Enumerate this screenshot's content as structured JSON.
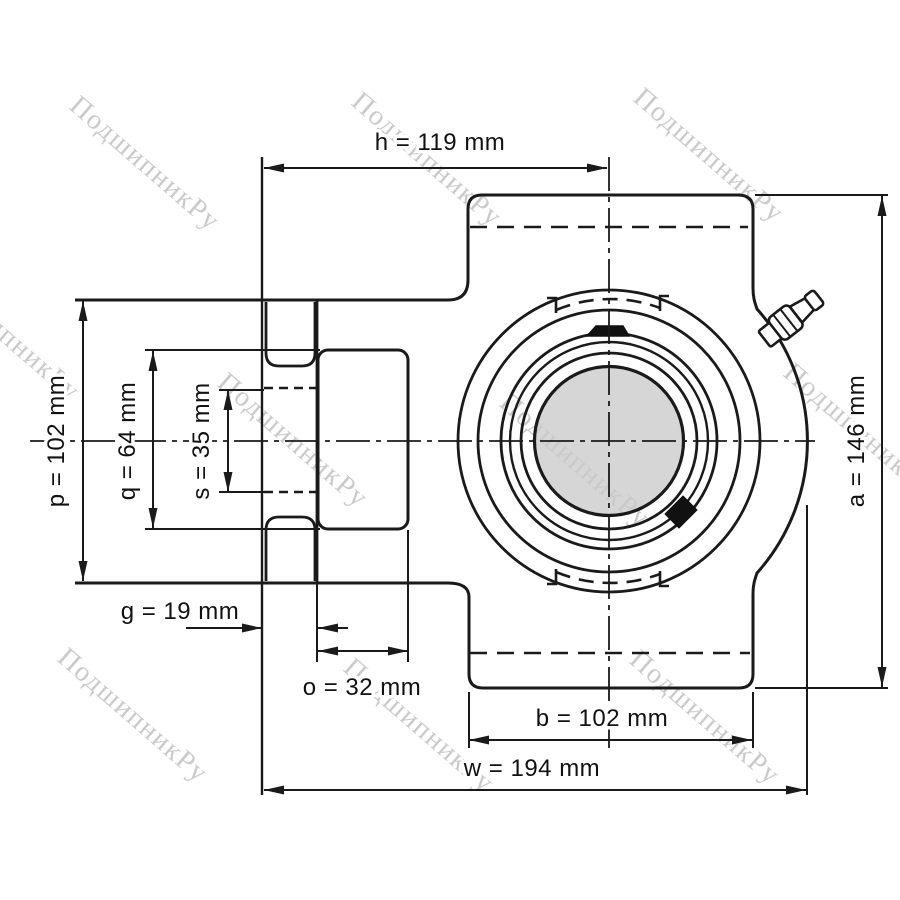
{
  "watermark": {
    "text": "ПодшипникРу",
    "color": "#cacaca"
  },
  "colors": {
    "line": "#1a1a1a",
    "bore_fill": "#d5d5d5",
    "background": "#ffffff"
  },
  "dimensions": {
    "h": {
      "label": "h = 119 mm",
      "value": 119,
      "unit": "mm"
    },
    "p": {
      "label": "p = 102 mm",
      "value": 102,
      "unit": "mm"
    },
    "q": {
      "label": "q = 64 mm",
      "value": 64,
      "unit": "mm"
    },
    "s": {
      "label": "s = 35 mm",
      "value": 35,
      "unit": "mm"
    },
    "g": {
      "label": "g = 19 mm",
      "value": 19,
      "unit": "mm"
    },
    "o": {
      "label": "o = 32 mm",
      "value": 32,
      "unit": "mm"
    },
    "b": {
      "label": "b = 102 mm",
      "value": 102,
      "unit": "mm"
    },
    "w": {
      "label": "w = 194 mm",
      "value": 194,
      "unit": "mm"
    },
    "a": {
      "label": "a = 146 mm",
      "value": 146,
      "unit": "mm"
    }
  }
}
